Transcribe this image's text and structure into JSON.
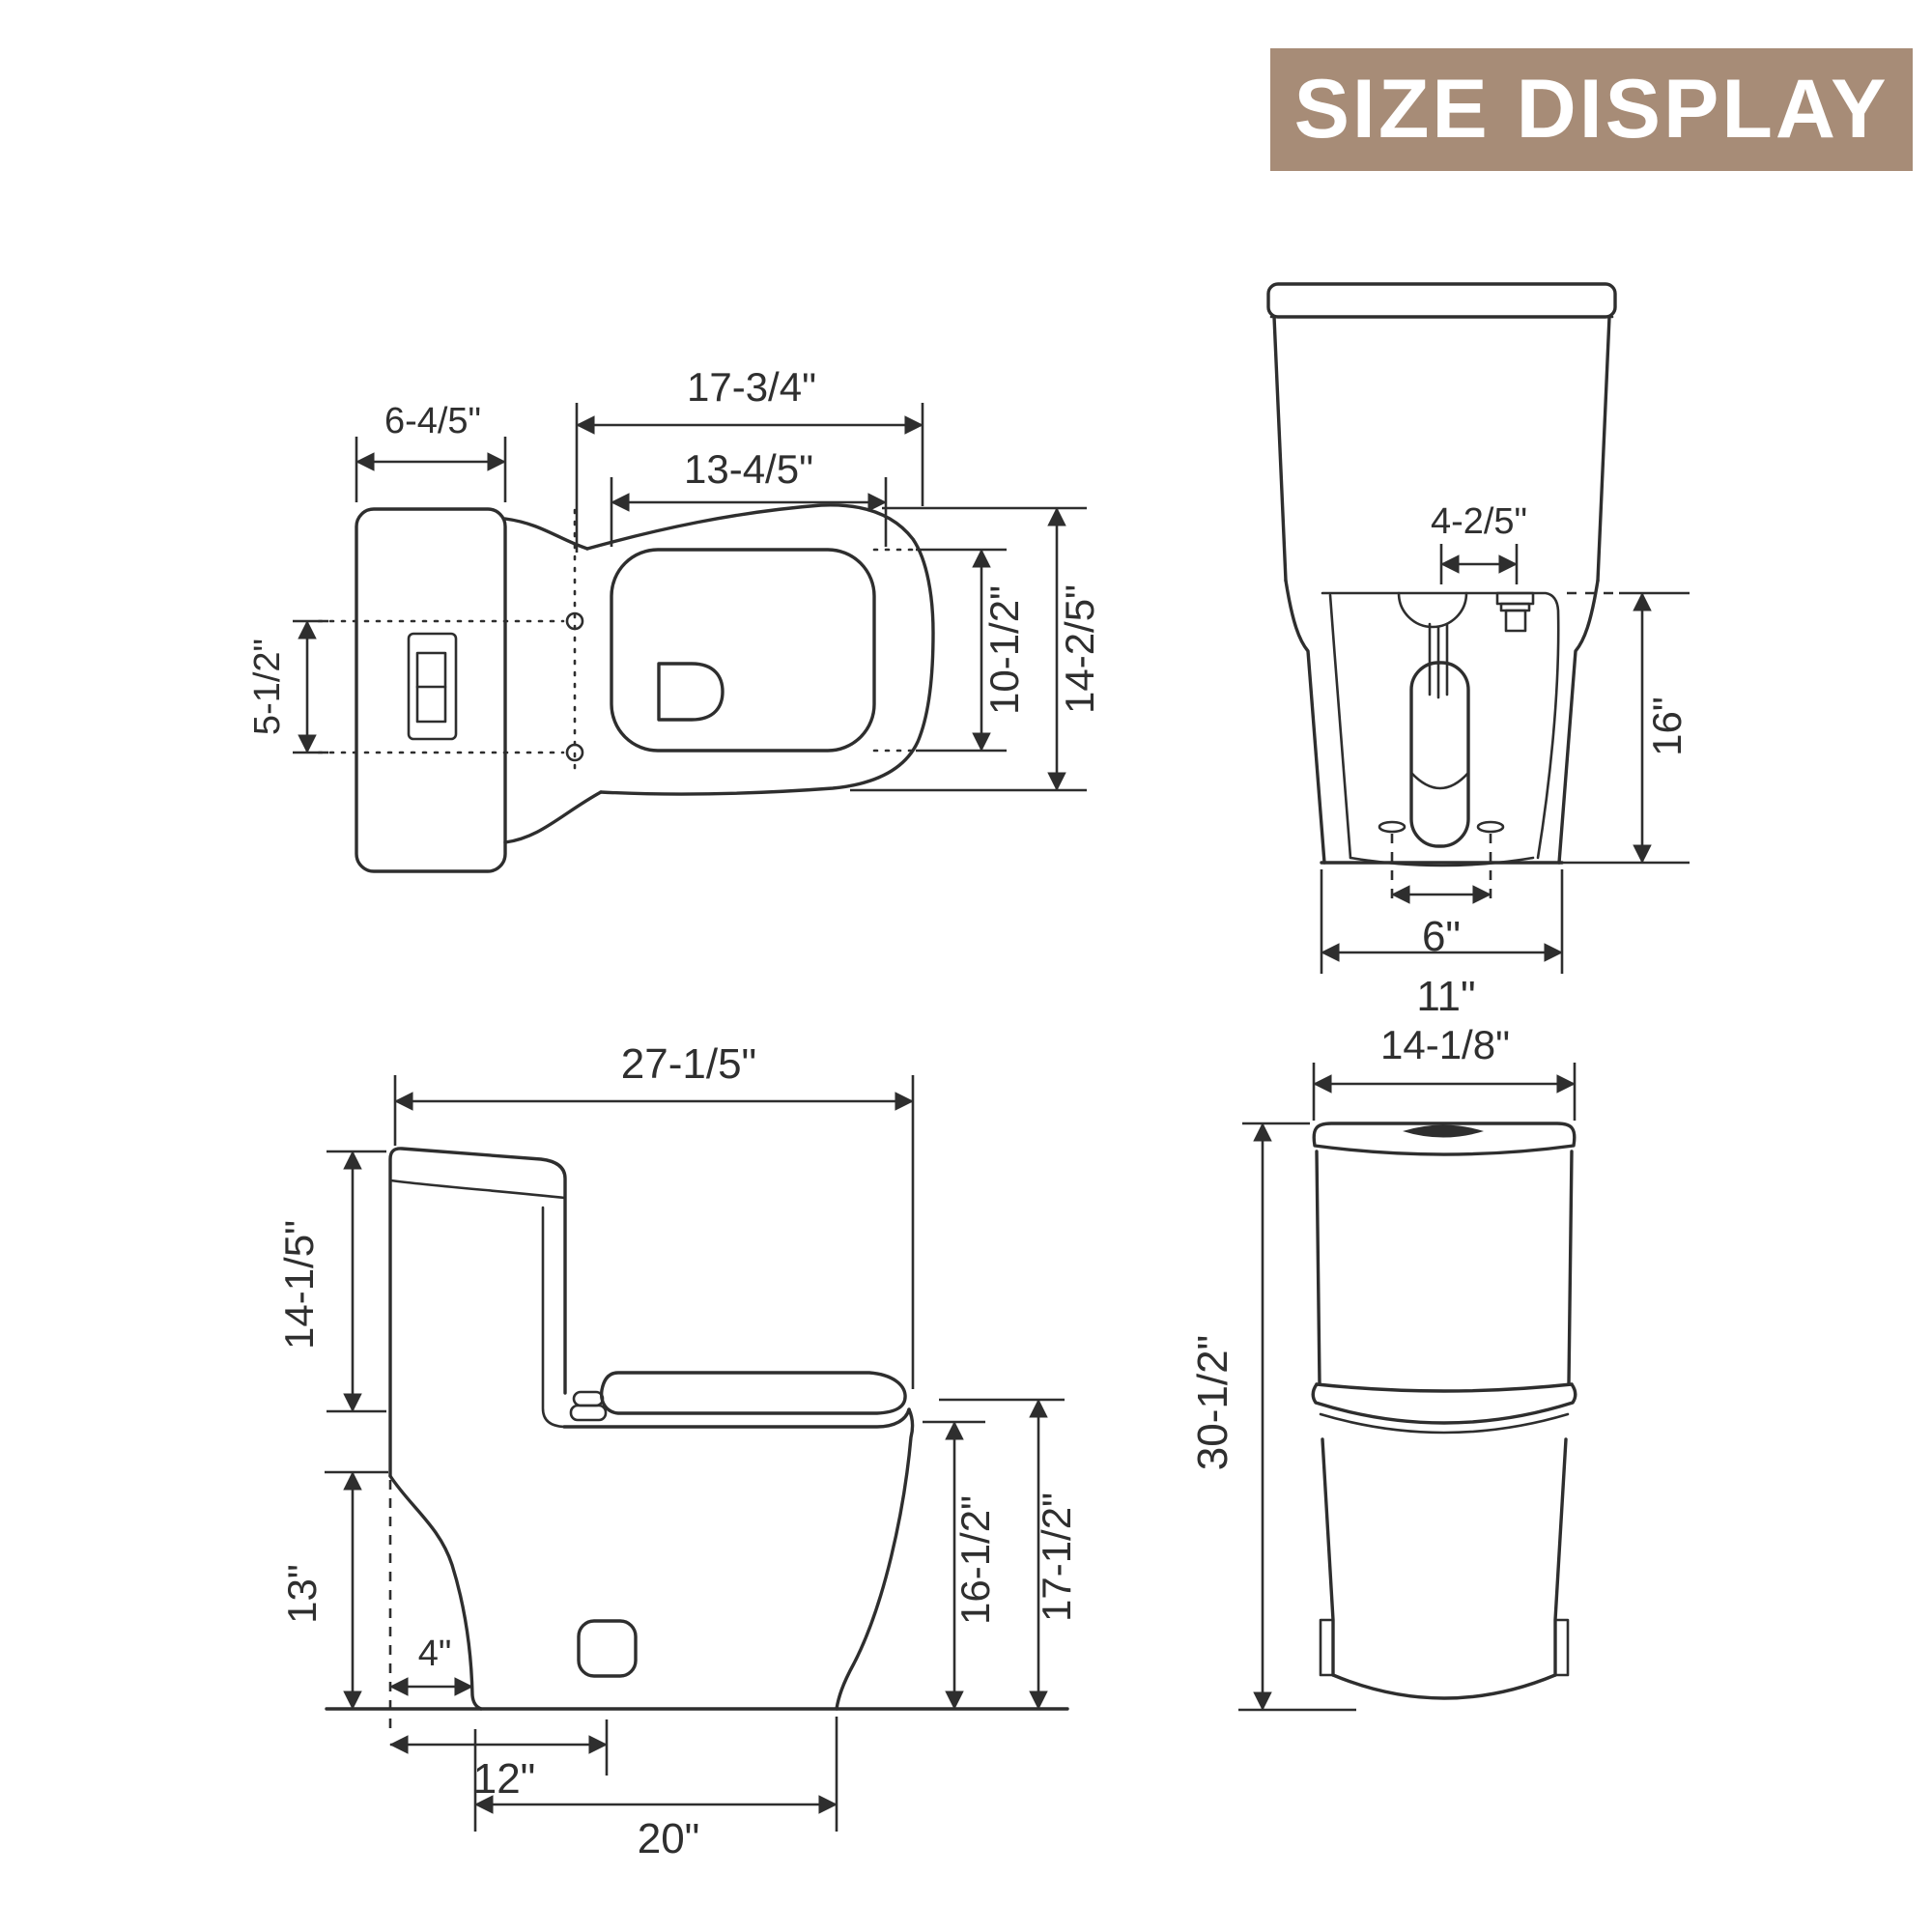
{
  "banner": {
    "title": "SIZE DISPLAY",
    "bg_color": "#a78c77",
    "text_color": "#ffffff"
  },
  "drawing": {
    "line_color": "#2e2e2e",
    "background": "#ffffff"
  },
  "top_view": {
    "dim_tank_depth": "6-4/5\"",
    "dim_outer_length": "17-3/4\"",
    "dim_inner_length": "13-4/5\"",
    "dim_button_spacing": "5-1/2\"",
    "dim_bowl_width": "10-1/2\"",
    "dim_overall_width": "14-2/5\""
  },
  "back_view": {
    "dim_valve_offset": "4-2/5\"",
    "dim_tank_to_base_height": "16\"",
    "dim_bolt_spacing": "6\"",
    "dim_base_width": "11\""
  },
  "side_view": {
    "dim_overall_depth": "27-1/5\"",
    "dim_tank_height": "14-1/5\"",
    "dim_bowl_height": "13\"",
    "dim_trap_setback": "4\"",
    "dim_rough_in": "12\"",
    "dim_base_depth": "20\"",
    "dim_rim_height": "16-1/2\"",
    "dim_seat_height": "17-1/2\""
  },
  "front_view": {
    "dim_width": "14-1/8\"",
    "dim_overall_height": "30-1/2\""
  }
}
